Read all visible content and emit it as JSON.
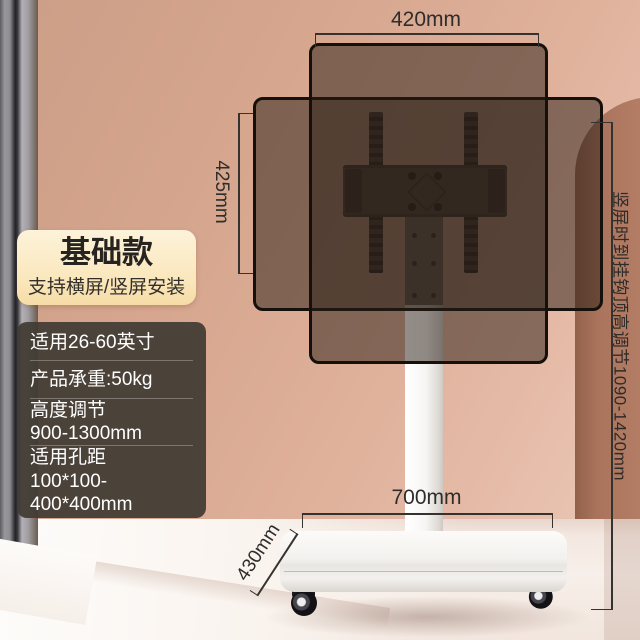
{
  "badge": {
    "title": "基础款",
    "subtitle": "支持横屏/竖屏安装"
  },
  "specs": {
    "rows": [
      {
        "lines": [
          "适用26-60英寸"
        ]
      },
      {
        "lines": [
          "产品承重:50kg"
        ]
      },
      {
        "lines": [
          "高度调节",
          "900-1300mm"
        ]
      },
      {
        "lines": [
          "适用孔距",
          "100*100-400*400mm"
        ]
      }
    ]
  },
  "dimensions": {
    "screen_width": "420mm",
    "screen_height": "425mm",
    "base_width": "700mm",
    "base_depth": "430mm",
    "hook_height_note": "竖屏时到挂钩顶高调节1090-1420mm"
  },
  "colors": {
    "wall": "#dcab94",
    "arch": "#b57e66",
    "badge_bg": "#fbe9c3",
    "panel_bg": "#423b34",
    "annotation": "#2e2d2b",
    "screen_overlay": "rgba(40,28,20,0.5)",
    "base": "#f3f1ee"
  }
}
